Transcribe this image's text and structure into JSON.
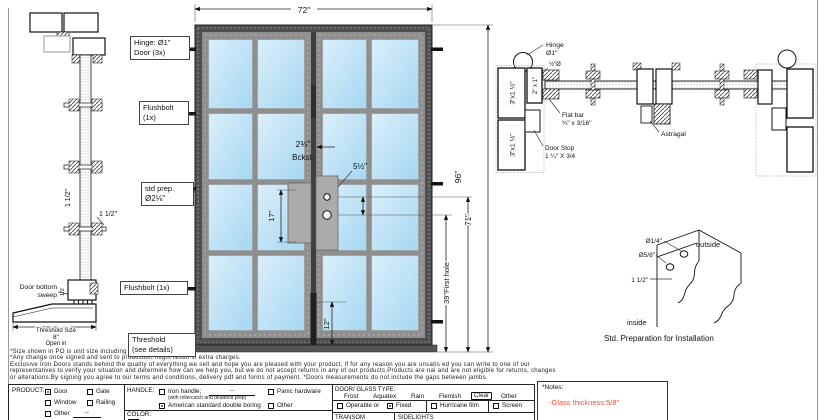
{
  "colors": {
    "glass_top": "#dbeffb",
    "glass_bottom": "#a5d7f1",
    "frame": "#4f4f4f",
    "note_red": "#f0503c"
  },
  "side_view": {
    "spacing_dim": "1 1/2\"",
    "muntin_dim": "1 1/2\"",
    "sweep_label_line1": "Door bottom",
    "sweep_label_line2": "sweep",
    "sweep_dim": "1/2",
    "threshold_label": "Threshold Size",
    "threshold_value": "8\"",
    "threshold_swing": "Open in"
  },
  "elevation": {
    "width_dim": "72\"",
    "height_dim": "96\"",
    "handle_height_dim": "71\"",
    "first_hole_dim": "39\"First hole",
    "lock_spacing_dim": "17\"",
    "bottom_rail_dim": "12\"",
    "hole_spacing_dim": "5½\"",
    "backset_value": "2¾\"",
    "backset_label": "Bckst.",
    "callout_hinge_line1": "Hinge: Ø1\"",
    "callout_hinge_line2": "Door (3x)",
    "callout_flushbolt_top_line1": "Flushbolt",
    "callout_flushbolt_top_line2": "(1x)",
    "callout_prep_line1": "std prep.",
    "callout_prep_line2": "Ø2⅛\"",
    "callout_flushbolt_bottom": "Flushbolt (1x)",
    "callout_threshold_line1": "Threshold",
    "callout_threshold_line2": "(see details)"
  },
  "plan_view": {
    "hinge_line1": "Hinge",
    "hinge_line2": "Ø1\"",
    "anchor_dim": "½\"Ø",
    "jamb_tube_a": "3\"x1 ½\"",
    "jamb_tube_b": "3\"x1 ½\"",
    "stop_tube": "2\" x 1\"",
    "flat_bar_line1": "Flat bar",
    "flat_bar_line2": "¾\" x 3/16\"",
    "door_stop_line1": "Door Stop",
    "door_stop_line2": "1 ¼\" X 3/4",
    "astragal": "Astragal"
  },
  "install_detail": {
    "hole_small": "Ø1/4\"",
    "hole_big": "Ø5/8\"",
    "edge_dist": "1 1/2\"",
    "outside": "outside",
    "inside": "inside",
    "caption": "Std. Preparation for Installation"
  },
  "fine_print": [
    "*Size shown in PO is unit size including frame and threshold.",
    "*Any change once signed and sent to production might result in extra charges.",
    "Exclusive Iron Doors stands behind the quality of everything we sell and hope you are pleased with your product, if for any reason you are unsatis ed you can write to one of our",
    "representatives to verify your situation and determine how can we help you, but we do not accept returns in any of our products.Products are  nal and are not eligible for returns, changes",
    "or alterations.By signing you agree to our terms and conditions, delivery pdf and forms of payment. *Doors measurements do not include the gaps between jambs."
  ],
  "title_block": {
    "product": {
      "label": "PRODUCT:",
      "opt_door": "Door",
      "door_checked": true,
      "opt_gate": "Gate",
      "opt_window": "Window",
      "opt_railing": "Railing",
      "opt_other": "Other",
      "other_fill": "--"
    },
    "handle": {
      "label": "HANDLE:",
      "opt_iron": "Iron handle;",
      "iron_fill": "--",
      "iron_note": "(with rollercatch and deadbolt prep)",
      "opt_american": "American standard double boring",
      "american_checked": true,
      "opt_panic": "Panic hardware",
      "opt_other": "Other"
    },
    "color": {
      "label": "COLOR:"
    },
    "glass": {
      "label": "DOOR/ GLASS TYPE:",
      "type_frost": "Frost",
      "type_aquatex": "Aquatex",
      "type_rain": "Rain",
      "type_flemish": "Flemish",
      "type_clear": "Clear",
      "type_other": "Other",
      "selected": "Clear",
      "opt_operable": "Operable or",
      "opt_fixed": "Fixed",
      "fixed_checked": true,
      "opt_hurricane": "Hurricane film",
      "opt_screen": "Screen",
      "row_transom": "TRANSOM",
      "row_sidelights": "SIDELIGHTS"
    },
    "notes": {
      "label": "*Notes:",
      "note": "-Glass thickness:5/8\""
    }
  }
}
